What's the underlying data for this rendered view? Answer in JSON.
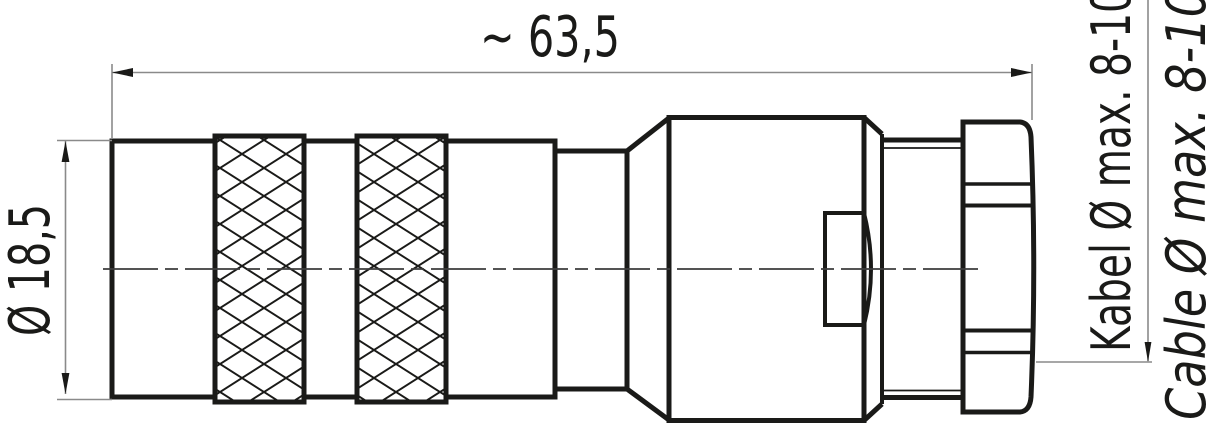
{
  "drawing": {
    "dimensions": {
      "overall_length": "~ 63,5",
      "body_diameter": "Ø 18,5"
    },
    "cable_labels": {
      "german": "Kabel Ø max. 8-10",
      "english": "Cable Ø max. 8-10"
    },
    "colors": {
      "line": "#1a1a18",
      "dimension_line": "#8a8a8a",
      "background": "#ffffff"
    }
  }
}
